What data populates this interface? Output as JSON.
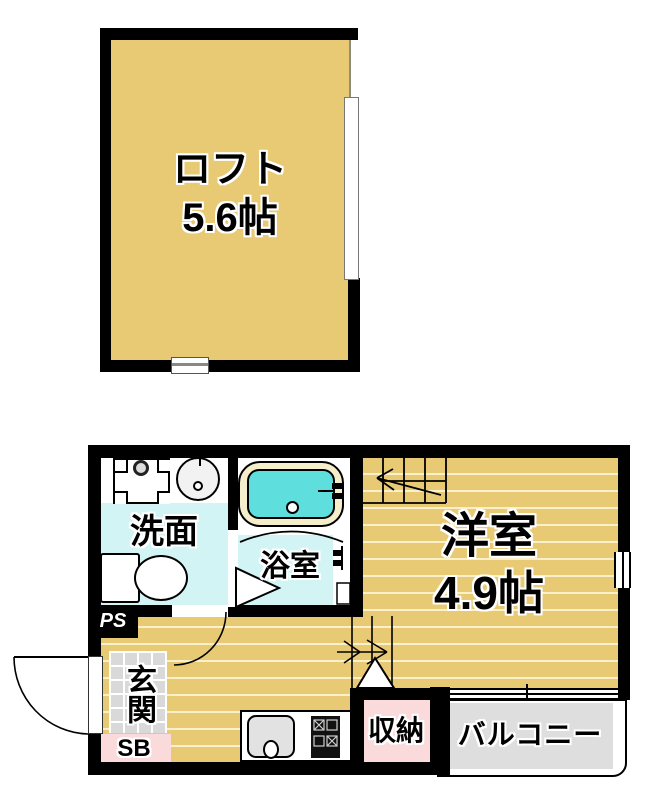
{
  "floorplan": {
    "loft": {
      "name_label": "ロフト",
      "size_label": "5.6帖"
    },
    "rooms": {
      "washroom_label": "洗面",
      "bathroom_label": "浴室",
      "western_room_label": "洋室",
      "western_room_size": "4.9帖",
      "entrance_label": "玄関",
      "storage_label": "収納",
      "balcony_label": "バルコニー",
      "pipe_space_label": "PS",
      "shoe_box_label": "SB"
    },
    "fixtures": {
      "bathtub": "bathtub-icon",
      "toilet": "toilet-icon",
      "washbasin": "washbasin-icon",
      "washer_pan": "washing-machine-pan-icon",
      "kitchen_sink": "kitchen-sink-icon",
      "stove": "stove-icon",
      "stairs_up": "stairs-icon",
      "door_swing": "door-arc-icon"
    },
    "colors": {
      "floor_tan": "#e8c974",
      "wet_floor": "#d2f4f4",
      "bath_water": "#5fdede",
      "bath_rim": "#f4eecb",
      "pink": "#fadada",
      "balcony_gray": "#dedede",
      "tile_gray": "#d9d9d9",
      "wall": "#000000"
    }
  }
}
